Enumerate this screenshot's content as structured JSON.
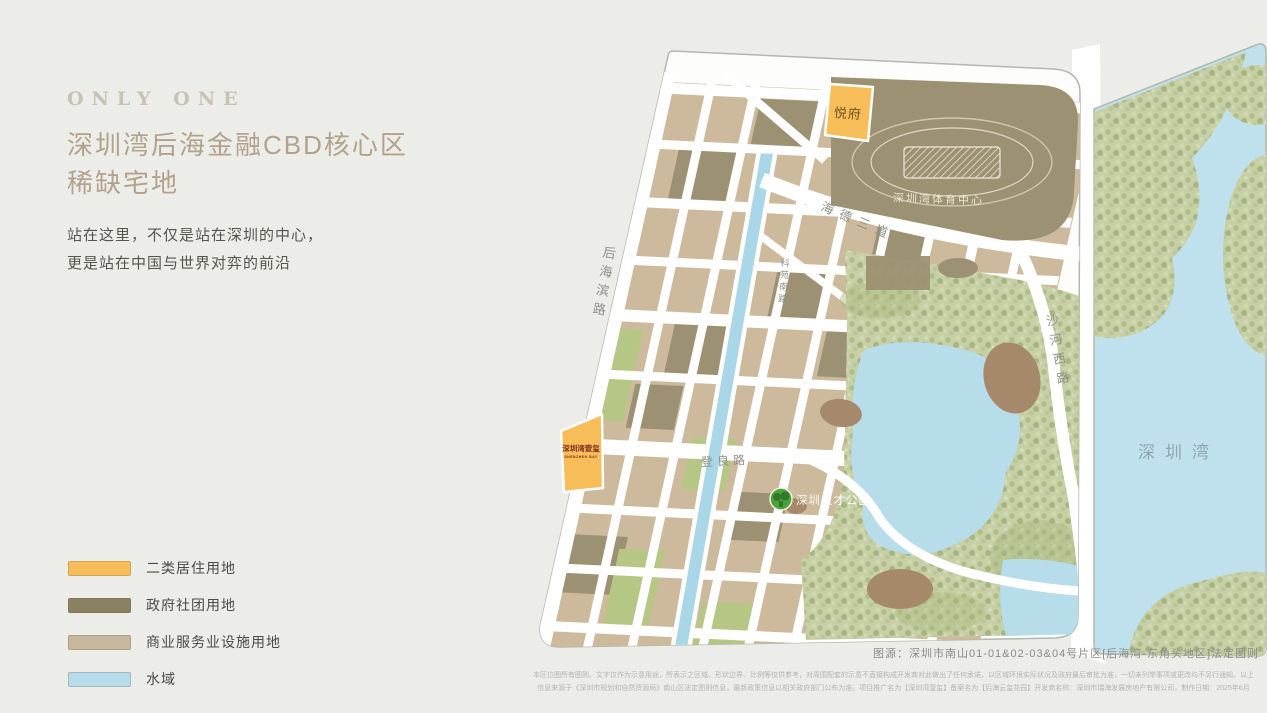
{
  "intro": {
    "eyebrow": "ONLY ONE",
    "title_line1": "深圳湾后海金融CBD核心区",
    "title_line2": "稀缺宅地",
    "subtitle_line1": "站在这里，不仅是站在深圳的中心，",
    "subtitle_line2": "更是站在中国与世界对弈的前沿"
  },
  "legend": {
    "items": [
      {
        "label": "二类居住用地",
        "color": "#F6BC5A"
      },
      {
        "label": "政府社团用地",
        "color": "#8A8163"
      },
      {
        "label": "商业服务业设施用地",
        "color": "#C7B79C"
      },
      {
        "label": "水域",
        "color": "#B6DCEB"
      }
    ]
  },
  "map": {
    "colors": {
      "panel_background": "#FDFDFB",
      "panel_border": "#B3B7B1",
      "residential_orange": "#F7BD59",
      "government_olive": "#9C9172",
      "commercial_tan": "#CDBA9D",
      "water_blue": "#B7DCEA",
      "bay_blue": "#BFE0ED",
      "park_green": "#C6CFA5",
      "road_white": "#FFFFFF"
    },
    "labels": {
      "yuefu": "悦府",
      "sports_center": "深圳湾体育中心",
      "haide_third_ave": "海德三道",
      "houhai_bin_road": "后海滨路",
      "keyuan_south_road": "科苑南路",
      "dengliang_road": "登良路",
      "shahe_west_road": "沙河西路",
      "talent_park": "深圳人才公园",
      "shenzhen_bay": "深圳湾",
      "project_parcel": "深圳湾壹玺",
      "project_parcel_sub": "SHENZHEN BAY"
    }
  },
  "footer": {
    "source": "图源：深圳市南山01-01&02-03&04号片区[后海湾-东角头地区]法定图则",
    "disclaimer_line1": "本区位图所有图则、文字仅作为示意用途，所表示之区域、形状边界、比例等仅供参考，对周围配套的示意不直接构成开发商对此做出了任何承诺，以区域环境实际状况及政府最后审批为准，一切未列举事项或更改均不另行通知。以上",
    "disclaimer_line2": "信息来源于《深圳市规划和自然资源局》南山区法定图则信息，最新政策信息以相关政府部门公布为准。项目推广名为【深圳湾壹玺】备案名为【后海云玺花园】开发商名称：深圳市瑞海发展房地产有限公司，制作日期：2025年6月"
  }
}
